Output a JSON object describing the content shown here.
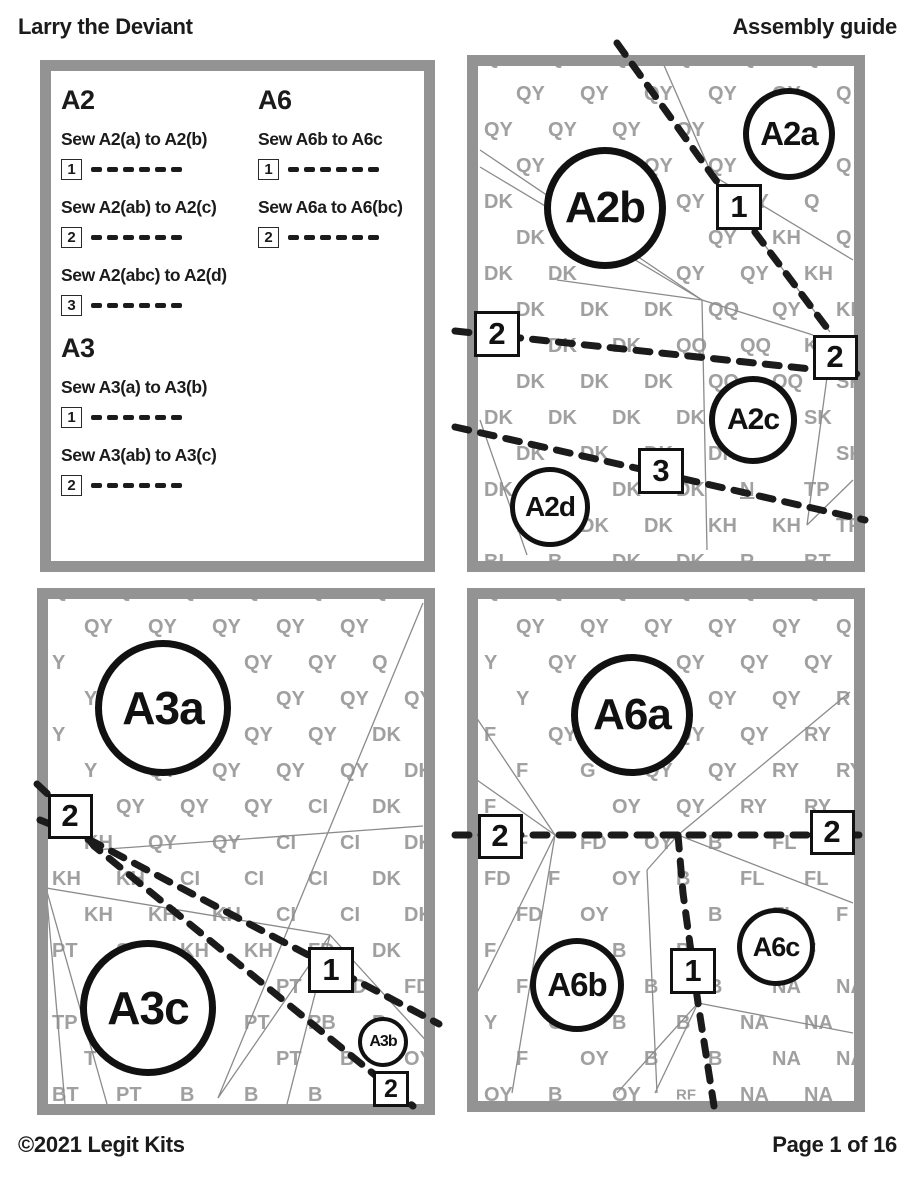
{
  "header": {
    "title": "Larry the Deviant",
    "subtitle": "Assembly guide"
  },
  "footer": {
    "copyright": "©2021 Legit Kits",
    "page": "Page 1 of 16"
  },
  "colors": {
    "ink": "#1b1b1b",
    "panel_border": "#939393",
    "code_text": "#a0a0a0",
    "seam_line": "#8b8b8b"
  },
  "instructions": {
    "col1": [
      {
        "title": "A2",
        "steps": [
          {
            "num": "1",
            "label": "Sew A2(a) to A2(b)"
          },
          {
            "num": "2",
            "label": "Sew A2(ab) to A2(c)"
          },
          {
            "num": "3",
            "label": "Sew A2(abc) to A2(d)"
          }
        ]
      },
      {
        "title": "A3",
        "steps": [
          {
            "num": "1",
            "label": "Sew A3(a) to A3(b)"
          },
          {
            "num": "2",
            "label": "Sew A3(ab) to A3(c)"
          }
        ]
      }
    ],
    "col2": [
      {
        "title": "A6",
        "steps": [
          {
            "num": "1",
            "label": "Sew A6b to A6c"
          },
          {
            "num": "2",
            "label": "Sew A6a to A6(bc)"
          }
        ]
      }
    ]
  },
  "diagrams": [
    {
      "id": "A2",
      "grid": {
        "colW": 64,
        "rowH": 36,
        "offsetX": 6,
        "offsetY": -8,
        "stagger": 32
      },
      "rows": [
        [
          "QY",
          "QY",
          "QY",
          "QY",
          "QY",
          "Q"
        ],
        [
          "QY",
          "QY",
          "QY",
          "QY",
          "QY",
          "Q"
        ],
        [
          "QY",
          "QY",
          "QY",
          "QY",
          "",
          "Q"
        ],
        [
          "QY",
          "QY",
          "QY",
          "QY",
          "",
          "Q"
        ],
        [
          "DK",
          "QY",
          "",
          "QY",
          "QY",
          "Q"
        ],
        [
          "DK",
          "DK",
          "",
          "QY",
          "KH",
          "Q"
        ],
        [
          "DK",
          "DK",
          "",
          "QY",
          "QY",
          "KH"
        ],
        [
          "DK",
          "DK",
          "DK",
          "QQ",
          "QY",
          "KH"
        ],
        [
          "DK",
          "DK",
          "DK",
          "QQ",
          "QQ",
          "KH"
        ],
        [
          "DK",
          "DK",
          "DK",
          "QQ",
          "QQ",
          "SK"
        ],
        [
          "DK",
          "DK",
          "DK",
          "DK",
          "SK",
          "SK"
        ],
        [
          "DK",
          "DK",
          "DK",
          "DK",
          "",
          "SK"
        ],
        [
          "DK",
          "DK",
          "DK",
          "DK",
          "N",
          "TP"
        ],
        [
          "BI",
          "DK",
          "DK",
          "KH",
          "KH",
          "TP"
        ],
        [
          "BI",
          "B",
          "DK",
          "DK",
          "R",
          "BT"
        ]
      ],
      "circles": [
        {
          "label": "A2b",
          "cx": 138,
          "cy": 153,
          "r": 61,
          "bw": 7,
          "fs": 44
        },
        {
          "label": "A2a",
          "cx": 322,
          "cy": 79,
          "r": 46,
          "bw": 6,
          "fs": 33
        },
        {
          "label": "A2c",
          "cx": 286,
          "cy": 365,
          "r": 44,
          "bw": 6,
          "fs": 30
        },
        {
          "label": "A2d",
          "cx": 83,
          "cy": 452,
          "r": 40,
          "bw": 5,
          "fs": 28
        }
      ],
      "boxes": [
        {
          "label": "1",
          "cx": 272,
          "cy": 152,
          "s": 46,
          "fs": 31
        },
        {
          "label": "2",
          "cx": 30,
          "cy": 279,
          "s": 46,
          "fs": 31
        },
        {
          "label": "2",
          "cx": 368,
          "cy": 302,
          "s": 45,
          "fs": 31
        },
        {
          "label": "3",
          "cx": 194,
          "cy": 416,
          "s": 46,
          "fs": 31
        }
      ],
      "sew_lines": [
        [
          [
            150,
            -12
          ],
          [
            245,
            120
          ],
          [
            363,
            277
          ]
        ],
        [
          [
            -12,
            276
          ],
          [
            400,
            320
          ]
        ],
        [
          [
            -12,
            372
          ],
          [
            398,
            465
          ]
        ]
      ],
      "seam_lines": [
        [
          13,
          95,
          235,
          245
        ],
        [
          13,
          112,
          235,
          245
        ],
        [
          196,
          8,
          245,
          120
        ],
        [
          245,
          120,
          363,
          277
        ],
        [
          245,
          120,
          386,
          205
        ],
        [
          90,
          225,
          235,
          245
        ],
        [
          235,
          245,
          346,
          280
        ],
        [
          235,
          245,
          240,
          495
        ],
        [
          363,
          300,
          340,
          470
        ],
        [
          340,
          470,
          386,
          425
        ],
        [
          13,
          365,
          60,
          500
        ]
      ]
    },
    {
      "id": "A3",
      "grid": {
        "colW": 64,
        "rowH": 36,
        "offsetX": 4,
        "offsetY": -8,
        "stagger": 32
      },
      "rows": [
        [
          "QY",
          "QY",
          "QY",
          "QY",
          "QY",
          "Q"
        ],
        [
          "QY",
          "QY",
          "QY",
          "QY",
          "QY",
          ""
        ],
        [
          "Y",
          "QY",
          "",
          "QY",
          "QY",
          "Q"
        ],
        [
          "Y",
          "QY",
          "",
          "QY",
          "QY",
          "QY"
        ],
        [
          "Y",
          "QY",
          "",
          "QY",
          "QY",
          "DK"
        ],
        [
          "Y",
          "QY",
          "QY",
          "QY",
          "QY",
          "DK"
        ],
        [
          "QY",
          "QY",
          "QY",
          "QY",
          "CI",
          "DK"
        ],
        [
          "KH",
          "QY",
          "QY",
          "CI",
          "CI",
          "DK"
        ],
        [
          "KH",
          "KH",
          "CI",
          "CI",
          "CI",
          "DK"
        ],
        [
          "KH",
          "KH",
          "KH",
          "CI",
          "CI",
          "DK"
        ],
        [
          "PT",
          "SK",
          "KH",
          "KH",
          "FD",
          "DK"
        ],
        [
          "SK",
          "Y",
          "",
          "PT",
          "FD",
          "FD"
        ],
        [
          "TP",
          "T",
          "",
          "PT",
          "PB",
          "B"
        ],
        [
          "T",
          "BT",
          "",
          "PT",
          "B",
          "OY"
        ],
        [
          "BT",
          "PT",
          "B",
          "B",
          "B",
          "B"
        ]
      ],
      "circles": [
        {
          "label": "A3a",
          "cx": 126,
          "cy": 120,
          "r": 68,
          "bw": 7,
          "fs": 46
        },
        {
          "label": "A3c",
          "cx": 111,
          "cy": 420,
          "r": 68,
          "bw": 7,
          "fs": 46
        },
        {
          "label": "A3b",
          "cx": 346,
          "cy": 454,
          "r": 25,
          "bw": 4,
          "fs": 16
        }
      ],
      "boxes": [
        {
          "label": "2",
          "cx": 33,
          "cy": 228,
          "s": 45,
          "fs": 31
        },
        {
          "label": "1",
          "cx": 294,
          "cy": 382,
          "s": 46,
          "fs": 31
        },
        {
          "label": "2",
          "cx": 354,
          "cy": 501,
          "s": 36,
          "fs": 25
        }
      ],
      "sew_lines": [
        [
          [
            3,
            232
          ],
          [
            57,
            254
          ],
          [
            402,
            436
          ]
        ],
        [
          [
            0,
            196
          ],
          [
            33,
            227
          ],
          [
            57,
            258
          ],
          [
            376,
            518
          ]
        ]
      ],
      "seam_lines": [
        [
          386,
          15,
          181,
          510
        ],
        [
          57,
          262,
          386,
          238
        ],
        [
          9,
          300,
          293,
          347
        ],
        [
          293,
          347,
          181,
          510
        ],
        [
          293,
          347,
          250,
          516
        ],
        [
          293,
          347,
          393,
          457
        ],
        [
          9,
          300,
          70,
          516
        ],
        [
          9,
          300,
          28,
          516
        ]
      ]
    },
    {
      "id": "A6",
      "grid": {
        "colW": 64,
        "rowH": 36,
        "offsetX": 6,
        "offsetY": -8,
        "stagger": 32
      },
      "rows": [
        [
          "QY",
          "QY",
          "QY",
          "QY",
          "QY",
          "Q"
        ],
        [
          "QY",
          "QY",
          "QY",
          "QY",
          "QY",
          "Q"
        ],
        [
          "Y",
          "QY",
          "",
          "QY",
          "QY",
          "QY"
        ],
        [
          "Y",
          "QY",
          "",
          "QY",
          "QY",
          "R"
        ],
        [
          "F",
          "QY",
          "QY",
          "QY",
          "QY",
          "RY"
        ],
        [
          "F",
          "G",
          "QY",
          "QY",
          "RY",
          "RY"
        ],
        [
          "F",
          "",
          "OY",
          "QY",
          "RY",
          "RY"
        ],
        [
          "F",
          "FD",
          "OY",
          "B",
          "FL",
          "RY"
        ],
        [
          "FD",
          "F",
          "OY",
          "B",
          "FL",
          "FL"
        ],
        [
          "FD",
          "OY",
          "",
          "B",
          "FL",
          "F"
        ],
        [
          "F",
          "",
          "B",
          "B",
          "FL",
          "F"
        ],
        [
          "F",
          "OY",
          "B",
          "B",
          "NA",
          "NA"
        ],
        [
          "Y",
          "OY",
          "B",
          "B",
          "NA",
          "NA"
        ],
        [
          "F",
          "OY",
          "B",
          "B",
          "NA",
          "NA"
        ],
        [
          "OY",
          "B",
          "OY",
          "RF",
          "NA",
          "NA"
        ]
      ],
      "circles": [
        {
          "label": "A6a",
          "cx": 165,
          "cy": 127,
          "r": 61,
          "bw": 7,
          "fs": 44
        },
        {
          "label": "A6b",
          "cx": 110,
          "cy": 397,
          "r": 47,
          "bw": 6,
          "fs": 33
        },
        {
          "label": "A6c",
          "cx": 309,
          "cy": 359,
          "r": 39,
          "bw": 5,
          "fs": 27
        }
      ],
      "boxes": [
        {
          "label": "2",
          "cx": 33,
          "cy": 248,
          "s": 45,
          "fs": 31
        },
        {
          "label": "2",
          "cx": 365,
          "cy": 244,
          "s": 45,
          "fs": 31
        },
        {
          "label": "1",
          "cx": 226,
          "cy": 383,
          "s": 46,
          "fs": 31
        }
      ],
      "sew_lines": [
        [
          [
            -12,
            247
          ],
          [
            400,
            247
          ]
        ],
        [
          [
            211,
            247
          ],
          [
            216,
            305
          ],
          [
            231,
            415
          ],
          [
            247,
            518
          ]
        ]
      ],
      "seam_lines": [
        [
          3,
          120,
          88,
          247
        ],
        [
          0,
          185,
          88,
          247
        ],
        [
          383,
          104,
          211,
          247
        ],
        [
          211,
          247,
          386,
          315
        ],
        [
          231,
          415,
          386,
          445
        ],
        [
          231,
          415,
          188,
          505
        ],
        [
          231,
          415,
          150,
          505
        ],
        [
          88,
          247,
          45,
          505
        ],
        [
          88,
          247,
          0,
          425
        ],
        [
          211,
          247,
          180,
          282
        ],
        [
          180,
          282,
          190,
          505
        ]
      ]
    }
  ]
}
